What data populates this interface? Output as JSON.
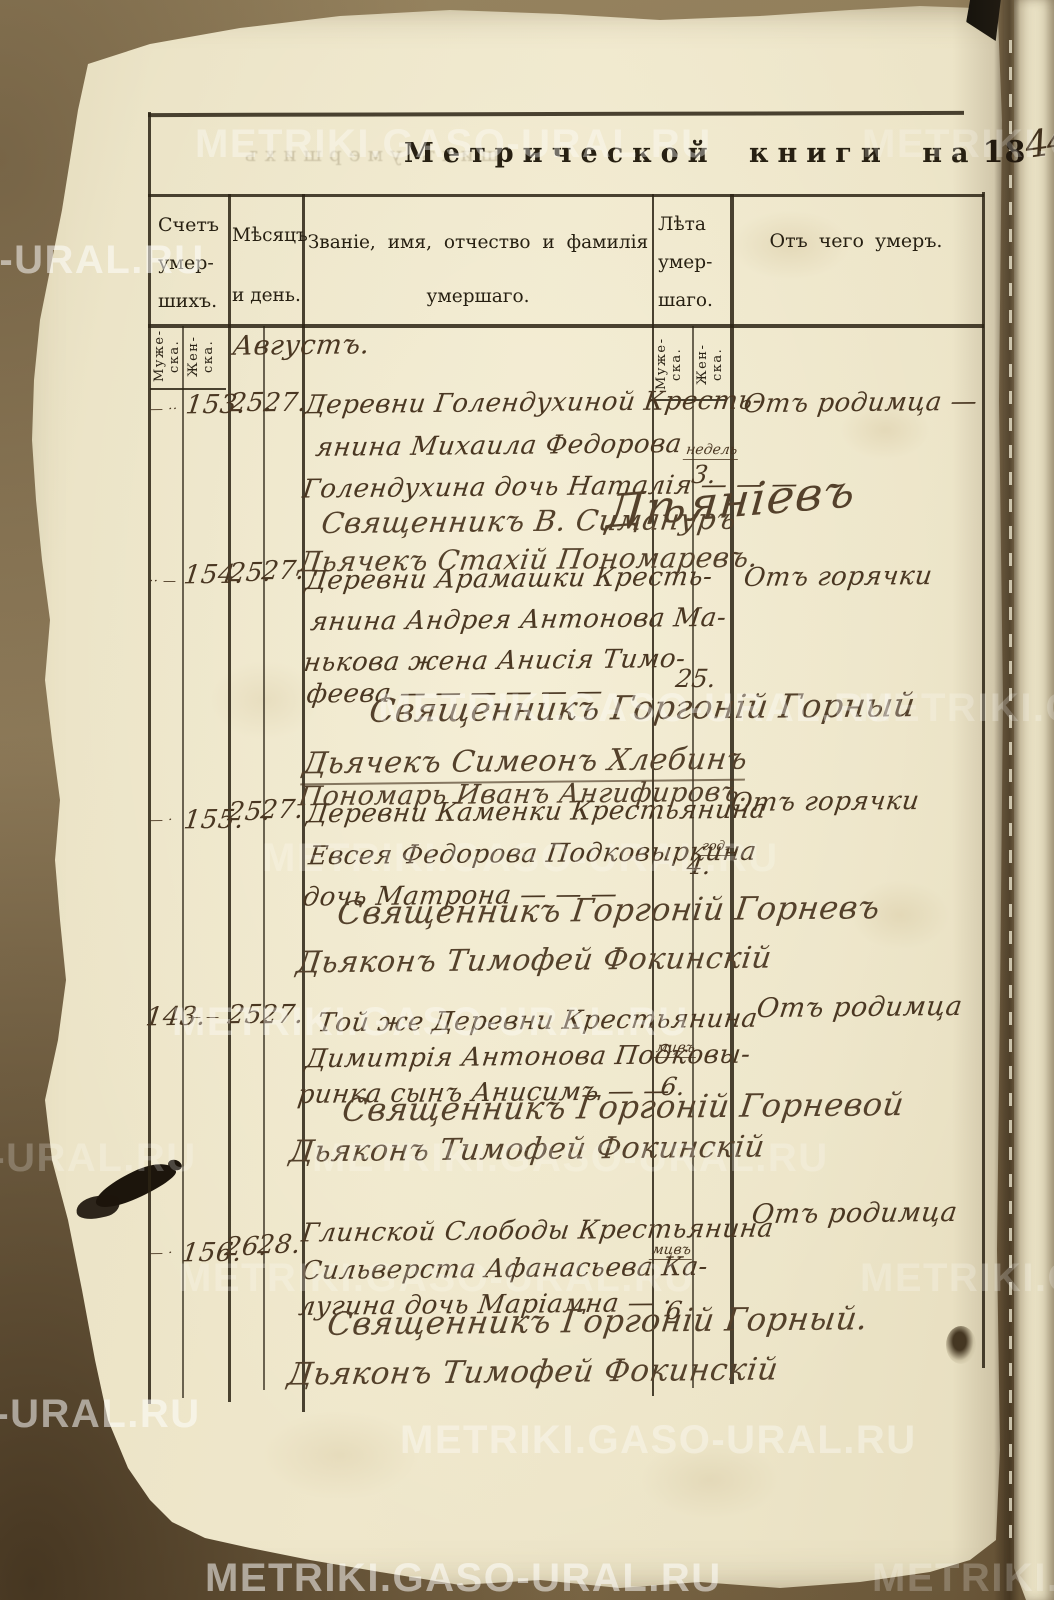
{
  "watermark": "METRIKI.GASO-URAL.RU",
  "title": {
    "text": "Метрической книги на",
    "year_printed": "18",
    "year_hand": "44"
  },
  "ghost_text": "шихъ умершихъ",
  "columns": {
    "count": {
      "l1": "Счетъ",
      "l2": "умер-",
      "l3": "шихъ."
    },
    "month": {
      "l1": "Мѣсяцъ",
      "l2": "и день."
    },
    "name": {
      "l1": "Званіе,  имя,  отчество  и  фамилія",
      "l2": "умершаго."
    },
    "age": {
      "l1": "Лѣта",
      "l2": "умер-",
      "l3": "шаго."
    },
    "cause": {
      "l1": "Отъ чего умеръ."
    },
    "male_1": "Муже-",
    "male_2": "ска.",
    "female_1": "Жен-",
    "female_2": "ска."
  },
  "month_label": "Августъ.",
  "entries": [
    {
      "num_male": "— ··",
      "num_female": "153.",
      "date1": "25.",
      "date2": "27.",
      "lines": [
        "Деревни Голендухиной Кресть-",
        "янина Михаила Федорова",
        "Голендухина дочь Наталія — — —",
        "Священникъ В. Симануръ",
        "Дьячекъ Стахій Пономаревъ."
      ],
      "signature": "Дѣяніевъ",
      "age_unit": "недель",
      "age_value": "3.",
      "cause": "Отъ родимца —"
    },
    {
      "num_male": "·· —",
      "num_female": "154.",
      "date1": "25.",
      "date2": "27.",
      "lines": [
        "Деревни Арамашки Кресть-",
        "янина Андрея Антонова Ма-",
        "нькова жена Анисія Тимо-",
        "феева — — — — — —",
        "Священникъ Горгоній Горный",
        "Дьячекъ Симеонъ Хлебинъ",
        "Пономарь Иванъ Ангифировъ."
      ],
      "age_value": "25.",
      "cause": "Отъ горячки"
    },
    {
      "num_male": "— ·",
      "num_female": "155.",
      "date1": "25.",
      "date2": "27.",
      "lines": [
        "Деревни Каменки Крестьянина",
        "Евсея Федорова Подковыркина",
        "дочь Матрона — — —",
        "Священникъ Горгоній Горневъ",
        "Дьяконъ Тимофей Фокинскій"
      ],
      "age_unit": "год.",
      "age_value": "4.",
      "cause": "Отъ горячки"
    },
    {
      "num_male": "143.",
      "num_female": "— —",
      "date1": "25.",
      "date2": "27.",
      "lines": [
        "Той же Деревни Крестьянина",
        "Димитрія Антонова Подковы-",
        "ринка сынъ Анисимъ — —",
        "Священникъ Горгоній Горневой",
        "Дьяконъ Тимофей Фокинскій"
      ],
      "age_unit": "мцвъ",
      "age_value": "6.",
      "cause": "Отъ родимца"
    },
    {
      "num_male": "— ·",
      "num_female": "156.",
      "date1": "26.",
      "date2": "28.",
      "lines": [
        "Глинской Слободы Крестьянина",
        "Сильверста Афанасьева Ка-",
        "лугина дочь Маріамна — ·",
        "Священникъ Горгоній Горный.",
        "Дьяконъ Тимофей Фокинскій"
      ],
      "age_unit": "мцвъ",
      "age_value": "6",
      "cause": "Отъ родимца"
    }
  ]
}
